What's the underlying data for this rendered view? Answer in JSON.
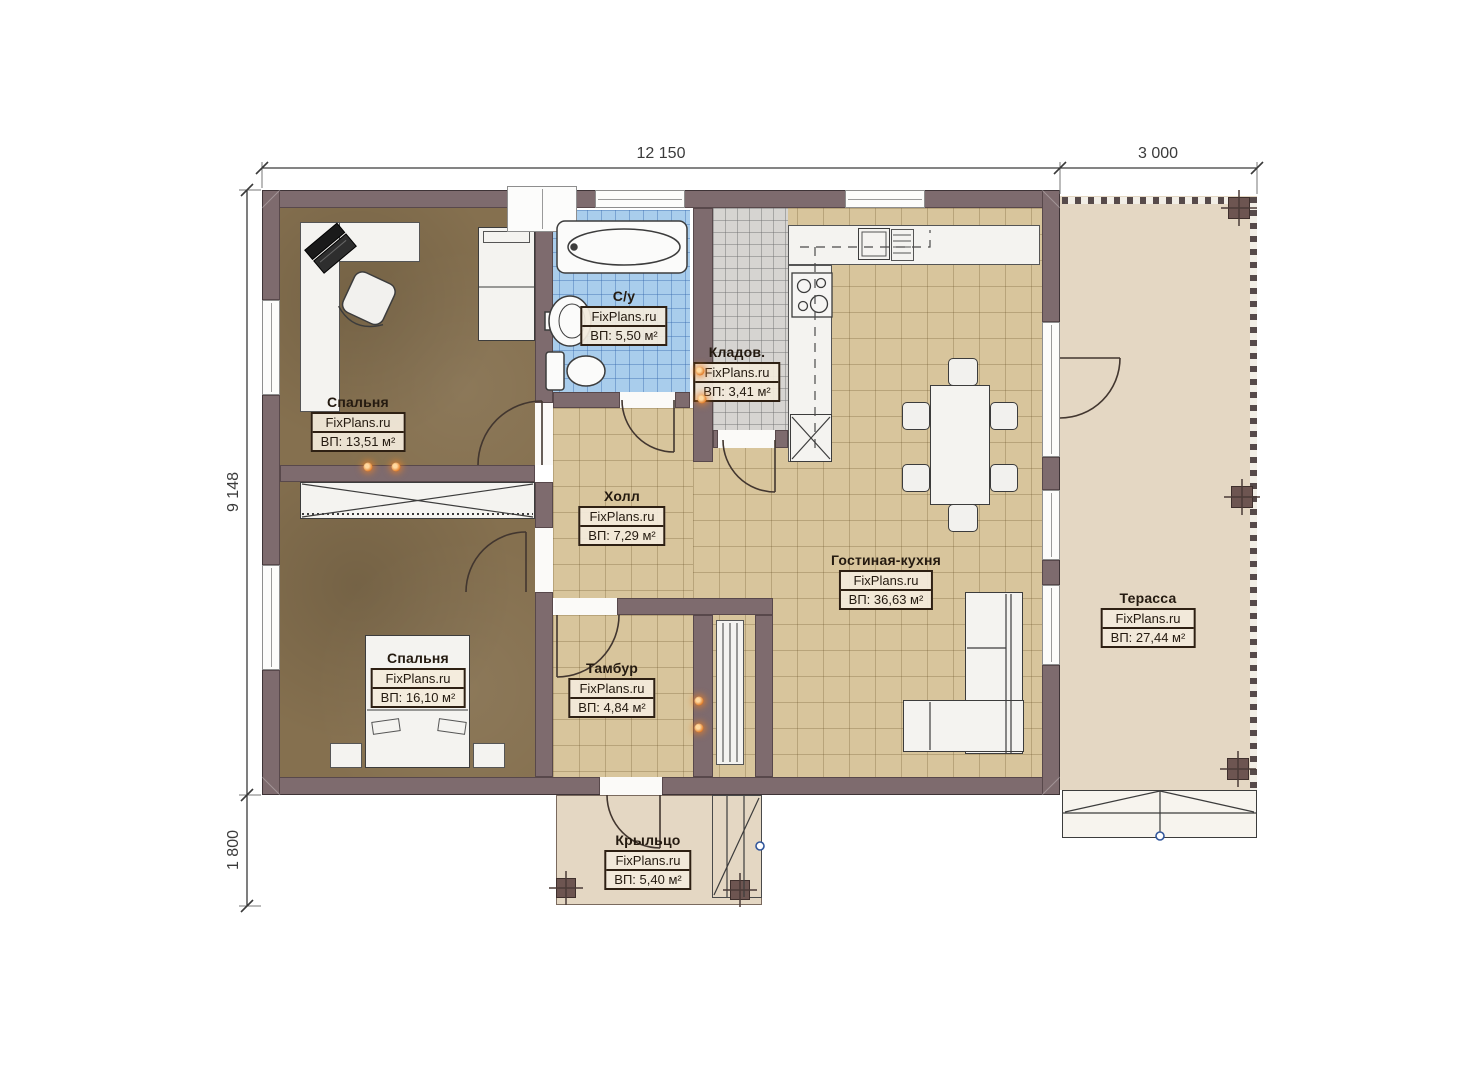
{
  "plan": {
    "brand": "FixPlans.ru",
    "dimensions": {
      "width_main": "12 150",
      "width_terrace": "3 000",
      "height_main": "9 148",
      "height_porch": "1 800"
    },
    "rooms": [
      {
        "name": "Спальня",
        "brand": "FixPlans.ru",
        "area": "ВП: 13,51 м²"
      },
      {
        "name": "С/у",
        "brand": "FixPlans.ru",
        "area": "ВП: 5,50 м²"
      },
      {
        "name": "Кладов.",
        "brand": "FixPlans.ru",
        "area": "ВП: 3,41 м²"
      },
      {
        "name": "Холл",
        "brand": "FixPlans.ru",
        "area": "ВП: 7,29 м²"
      },
      {
        "name": "Гостиная-кухня",
        "brand": "FixPlans.ru",
        "area": "ВП: 36,63 м²"
      },
      {
        "name": "Спальня",
        "brand": "FixPlans.ru",
        "area": "ВП: 16,10 м²"
      },
      {
        "name": "Тамбур",
        "brand": "FixPlans.ru",
        "area": "ВП: 4,84 м²"
      },
      {
        "name": "Терасса",
        "brand": "FixPlans.ru",
        "area": "ВП: 27,44 м²"
      },
      {
        "name": "Крыльцо",
        "brand": "FixPlans.ru",
        "area": "ВП: 5,40 м²"
      }
    ],
    "colors": {
      "wall": "#7e6b6e",
      "bedroom_floor": "#85704f",
      "tile_floor": "#d8c59c",
      "bath_floor": "#a9cdec",
      "storage_floor": "#d6d4d1",
      "terrace_floor": "#e4d7c3",
      "accent_dot": "#e07b28"
    }
  }
}
